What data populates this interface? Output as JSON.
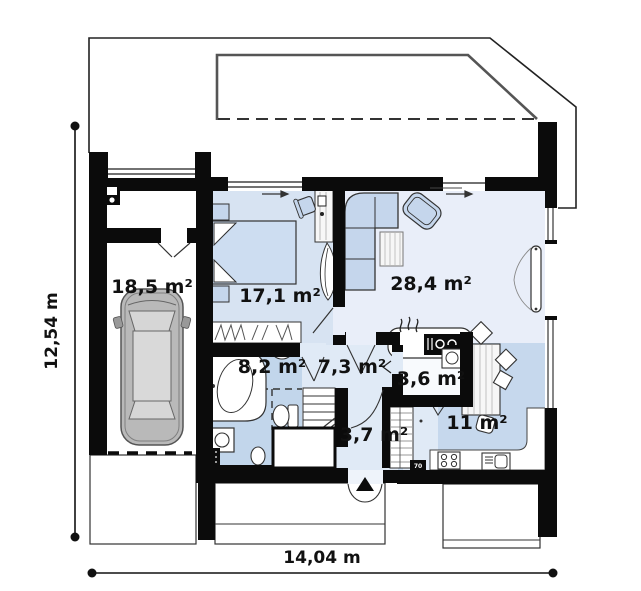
{
  "plan": {
    "title": "house-ground-floor-plan",
    "rooms": [
      {
        "name": "garage",
        "area_label": "18,5 m²"
      },
      {
        "name": "bedroom",
        "area_label": "17,1 m²"
      },
      {
        "name": "living-room",
        "area_label": "28,4 m²"
      },
      {
        "name": "bathroom",
        "area_label": "8,2 m²"
      },
      {
        "name": "hall",
        "area_label": "7,3 m²"
      },
      {
        "name": "utility",
        "area_label": "3,6 m²"
      },
      {
        "name": "entry",
        "area_label": "3,7 m²"
      },
      {
        "name": "kitchen",
        "area_label": "11 m²"
      }
    ],
    "dimensions": {
      "width_label": "14,04 m",
      "height_label": "12,54 m"
    },
    "wall_tags": [
      {
        "label": "70"
      }
    ],
    "colors": {
      "wall": "#0b0b0b",
      "bedroom_floor": "#d7e3f2",
      "living_floor": "#e9eef9",
      "hall_floor": "#e0eaf6",
      "bathroom_floor": "#c2d6eb",
      "kitchen_floor": "#c6d8ed",
      "furniture_blue": "#c5d6ec",
      "car_gray": "#b9b9b9"
    },
    "furniture_icons": [
      "car-icon",
      "double-bed-icon",
      "nightstand-icon",
      "wardrobe-icon",
      "desk-icon",
      "plant-icon",
      "corner-sofa-icon",
      "armchair-icon",
      "rug-icon",
      "fireplace-icon",
      "dining-table-icon",
      "chair-icon",
      "kitchen-counter-icon",
      "stove-icon",
      "kitchen-sink-icon",
      "bathtub-icon",
      "washing-machine-icon",
      "toilet-icon",
      "sink-icon",
      "radiator-icon",
      "boiler-icon",
      "stairs-icon",
      "entrance-door-icon",
      "electric-box-icon"
    ]
  }
}
